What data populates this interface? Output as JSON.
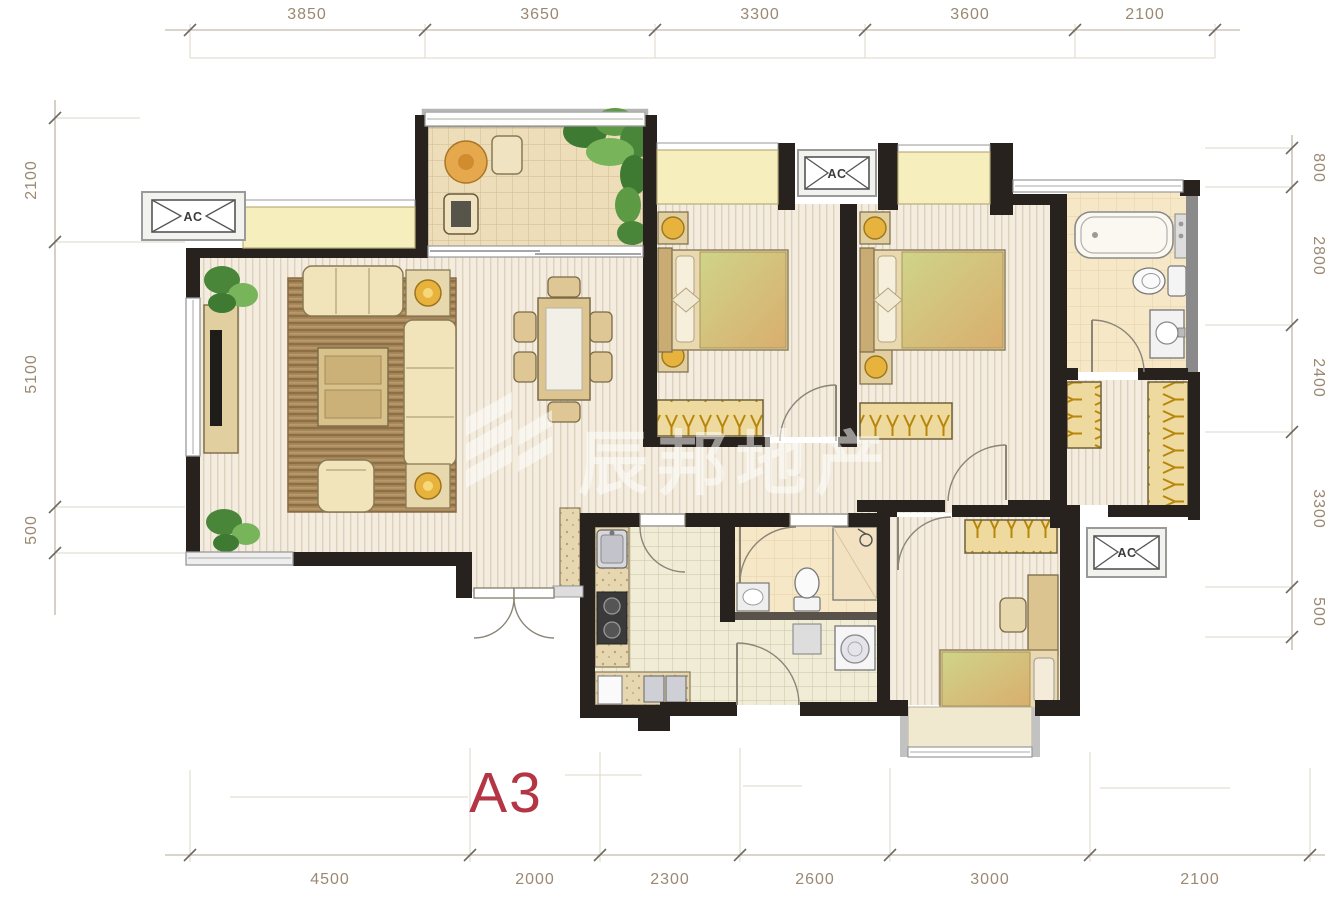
{
  "plan_label": "A3",
  "watermark": {
    "text": "辰邦地产",
    "logo": "chevron-building-logo"
  },
  "labels": {
    "ac": "AC"
  },
  "dimensions": {
    "top": [
      "3850",
      "3650",
      "3300",
      "3600",
      "2100"
    ],
    "bottom": [
      "4500",
      "2000",
      "2300",
      "2600",
      "3000",
      "2100"
    ],
    "left": [
      "2100",
      "5100",
      "500"
    ],
    "right": [
      "800",
      "2800",
      "2400",
      "3300",
      "500"
    ]
  },
  "colors": {
    "wall": "#27221e",
    "dimension_text": "#9a8872",
    "dimension_line": "#b3a998",
    "plan_title_red": "#b43543",
    "wood_floor": "#f3ecdf",
    "bay_window_yellow": "#f6eebc",
    "furniture_cream": "#f1e4bb",
    "furniture_wood": "#ddc592",
    "lamp_yellow": "#e8b33c",
    "rug_brown": "#a8875c",
    "plant_green": "#5d9a44",
    "tile_tan": "#eeddb9",
    "watermark_white": "#ffffff"
  }
}
